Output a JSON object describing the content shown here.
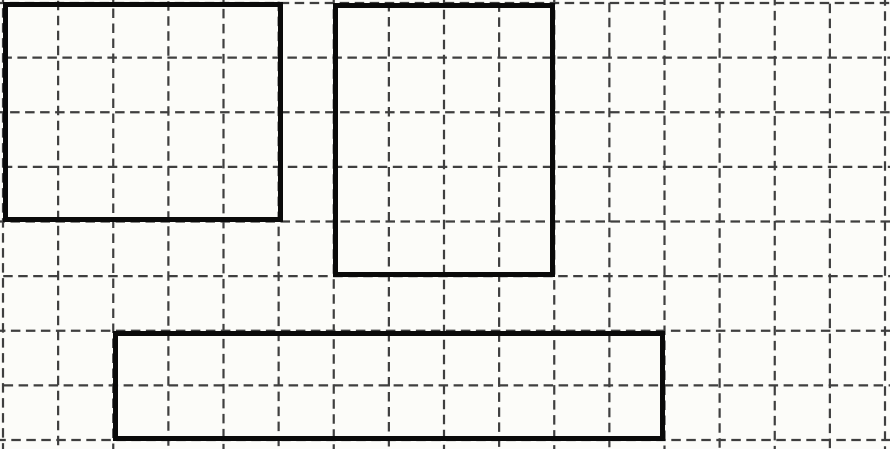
{
  "canvas": {
    "width": 890,
    "height": 449,
    "background_color": "#fcfcf9"
  },
  "grid": {
    "style": "dashed",
    "line_color": "#3f3f3f",
    "line_width": 2.2,
    "dash_length": 9.5,
    "gap_length": 5.5,
    "first_line_x": 3,
    "first_line_y": 3,
    "cell_width": 55.125,
    "cell_height": 54.625,
    "vertical_line_count": 17,
    "horizontal_line_count": 9,
    "columns": 16,
    "rows": 8
  },
  "shapes": [
    {
      "id": "rectangle-top-left",
      "x": 3,
      "y": 2,
      "width": 280,
      "height": 220,
      "cells_wide": 5,
      "cells_tall": 4,
      "border_color": "#0a0a0a",
      "border_width": 5
    },
    {
      "id": "rectangle-top-middle",
      "x": 333,
      "y": 3,
      "width": 222,
      "height": 274,
      "cells_wide": 4,
      "cells_tall": 5,
      "border_color": "#0a0a0a",
      "border_width": 5
    },
    {
      "id": "rectangle-bottom-wide",
      "x": 113,
      "y": 331,
      "width": 552,
      "height": 110,
      "cells_wide": 10,
      "cells_tall": 2,
      "border_color": "#0a0a0a",
      "border_width": 5
    }
  ]
}
